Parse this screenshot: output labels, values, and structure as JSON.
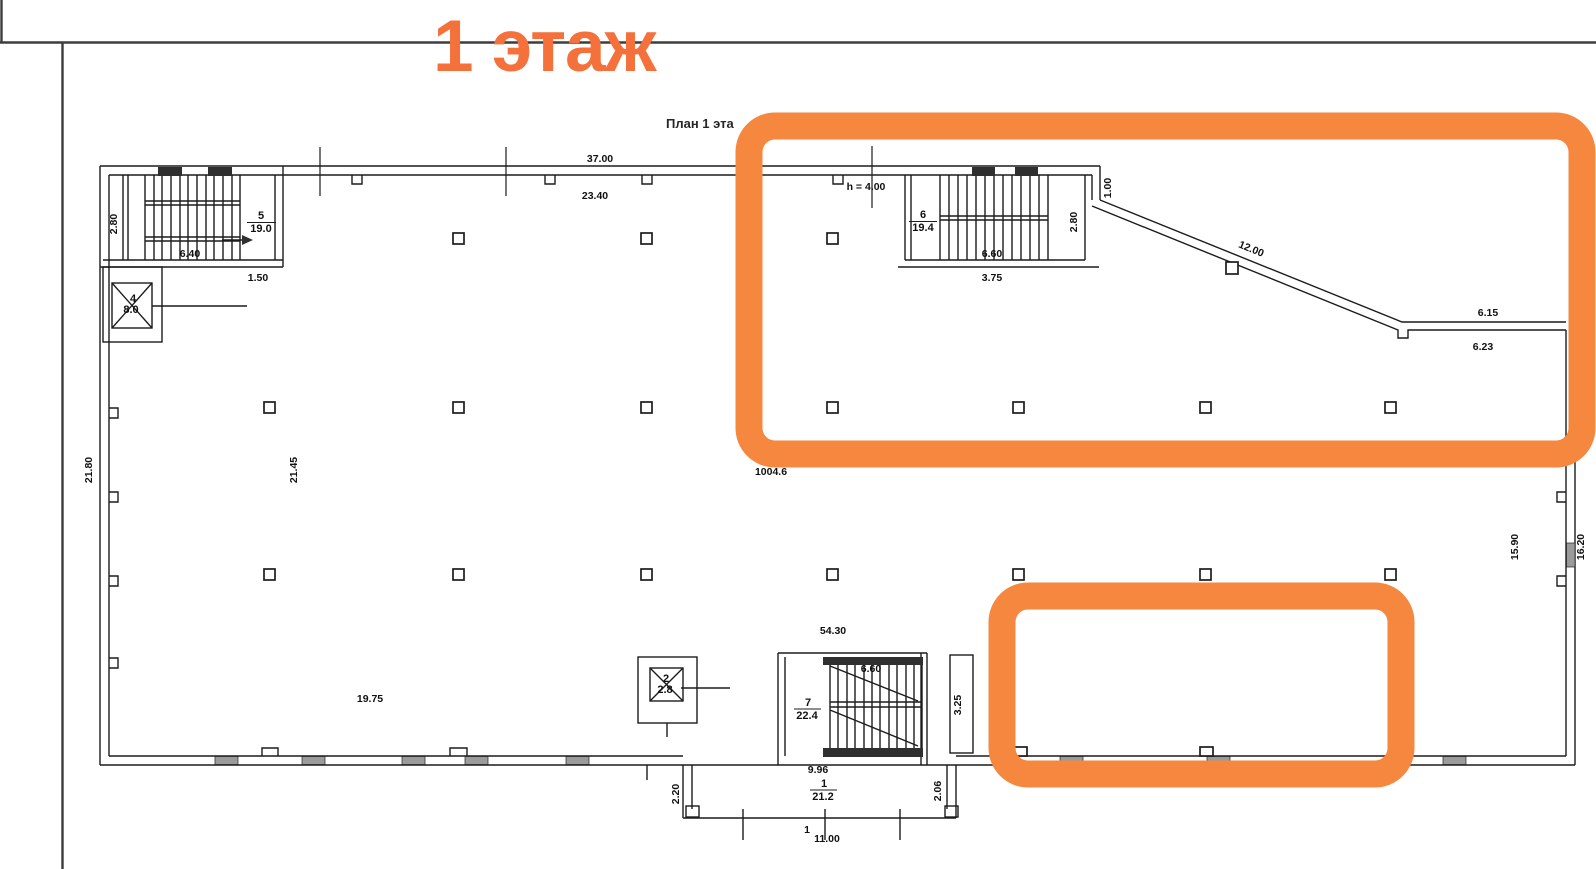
{
  "colors": {
    "highlight": "#f6873f",
    "title": "#f4713c",
    "ink": "#1c1c1c"
  },
  "title": "1 этаж",
  "caption": "План 1 эта",
  "note_h": "h = 4.00",
  "hall_area": "1004.6",
  "rooms": {
    "r1": {
      "number": "1",
      "area": "21.2"
    },
    "r2": {
      "number": "2",
      "area": "2.8"
    },
    "r4": {
      "number": "4",
      "area": "8.0"
    },
    "r5": {
      "number": "5",
      "area": "19.0"
    },
    "r6": {
      "number": "6",
      "area": "19.4"
    },
    "r7": {
      "number": "7",
      "area": "22.4"
    }
  },
  "dims": {
    "top_out": "37.00",
    "top_in": "23.40",
    "s5_w": "6.40",
    "s5_h": "2.80",
    "s5_off": "1.50",
    "s6_w": "6.60",
    "s6_below": "3.75",
    "s6_h": "2.80",
    "step": "1.00",
    "ramp": "12.00",
    "ramp_top": "6.15",
    "ramp_bot": "6.23",
    "left_out": "21.80",
    "left_in": "21.45",
    "right_in": "15.90",
    "right_out": "16.20",
    "mid": "54.30",
    "hall_w": "19.75",
    "s7_w": "6.60",
    "s7_below": "9.96",
    "s7_h": "3.25",
    "v_left": "2.20",
    "v_right": "2.06",
    "porch": "11.00",
    "axis": "1"
  }
}
